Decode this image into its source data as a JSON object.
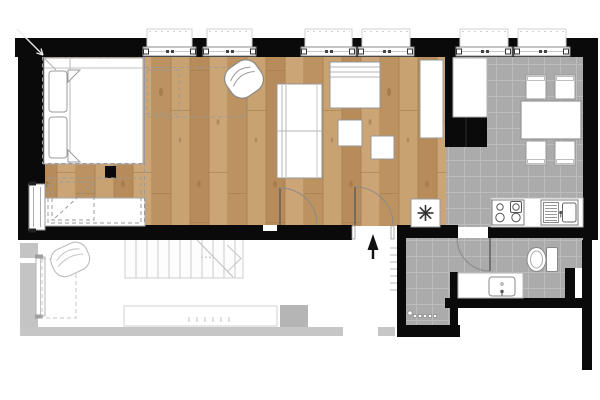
{
  "plan": {
    "kind": "apartment-floor-plan",
    "window_count": 6,
    "rooms": [
      {
        "name": "sleeping-area",
        "floor": "wood"
      },
      {
        "name": "living-area",
        "floor": "wood"
      },
      {
        "name": "kitchen-dining",
        "floor": "gray-tile"
      },
      {
        "name": "entry-hall",
        "floor": "gray-tile"
      },
      {
        "name": "bathroom",
        "floor": "gray-tile"
      },
      {
        "name": "lower-level-ghost",
        "floor": "faded-outline"
      }
    ],
    "furniture": [
      "double-bed-with-pillows",
      "desk-dresser",
      "black-column-stub",
      "left-wall-window",
      "round-armchair",
      "two-seat-sofa",
      "daybed-sofa",
      "side-table-1",
      "side-table-2",
      "tall-wardrobe",
      "tall-fridge-cabinet",
      "dining-table",
      "chair-1",
      "chair-2",
      "chair-3",
      "chair-4",
      "kitchen-counter",
      "cooktop-4-burners",
      "kitchen-sink",
      "asterisk-appliance",
      "toilet",
      "vanity-with-sink",
      "ghost-armchair",
      "ghost-staircase",
      "ghost-bar-counter",
      "hall-radiator-dots"
    ],
    "symbols": {
      "appliance_star": "eight-spoke-asterisk",
      "entrance_arrow": "solid-arrow-pointing-in",
      "corner_arrow": "diagonal-arrow-top-left"
    }
  },
  "colors": {
    "background": "#ffffff",
    "wall": "#0a0a0a",
    "wood_base": "#c39b6a",
    "wood_dark": "#b78c5a",
    "wood_mid": "#bb9260",
    "wood_light": "#cca577",
    "wood_gap": "#9c7848",
    "tile_floor": "#ababab",
    "tile_grid": "#bcbcbc",
    "furniture_fill": "#ffffff",
    "furniture_line": "#979797",
    "dashed_line": "#9a9a9a",
    "ghost_gray": "#c6c6c6",
    "ghost_block": "#b5b5b5",
    "ghost_line": "#c4c4c4",
    "door_line": "#7a7a7a"
  }
}
